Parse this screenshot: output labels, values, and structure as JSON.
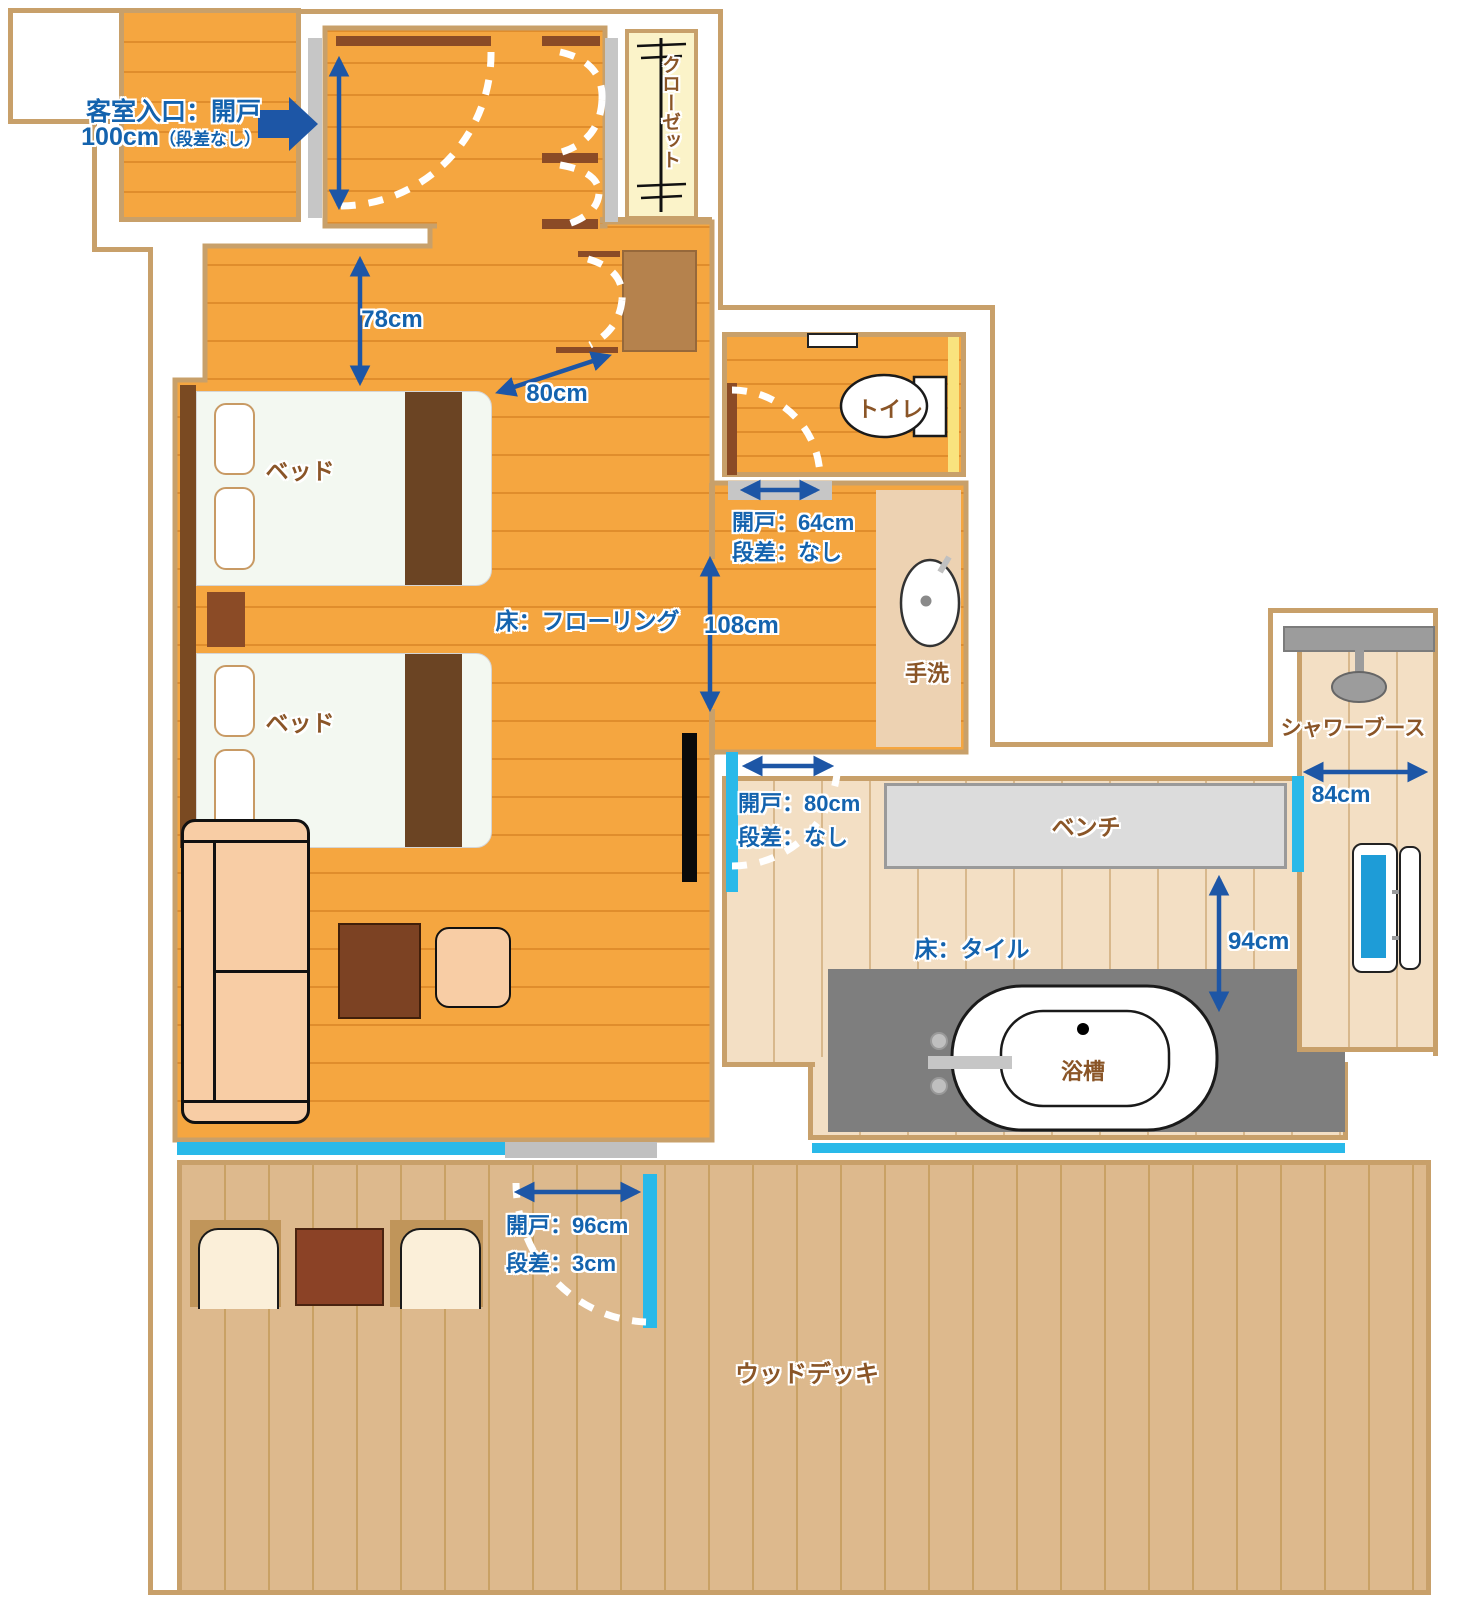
{
  "plan": {
    "entry": {
      "line1": "客室入口：開戸",
      "value": "100cm",
      "note": "（段差なし）"
    },
    "closet": {
      "label": "クローゼット"
    },
    "bedroom": {
      "bed1": "ベッド",
      "bed2": "ベッド",
      "floor": "床：フローリング"
    },
    "toilet": {
      "name": "トイレ",
      "door": "開戸：64cm",
      "step": "段差：なし"
    },
    "washbasin": {
      "label": "手洗"
    },
    "bathroom": {
      "floor": "床：タイル",
      "bench": "ベンチ",
      "tub": "浴槽",
      "shower": "シャワーブース",
      "door": "開戸：80cm",
      "step": "段差：なし"
    },
    "deck": {
      "name": "ウッドデッキ",
      "door": "開戸：96cm",
      "step": "段差：3cm"
    },
    "measurements": {
      "hall_width": "78cm",
      "closet_clearance": "80cm",
      "corridor_width": "108cm",
      "shower_width": "84cm",
      "bath_clearance": "94cm"
    },
    "colors": {
      "floor_orange": "#F5A640",
      "wall_tan": "#C8A06A",
      "tile_beige": "#F3DFC4",
      "deck_tan": "#DDB98D",
      "accent_cyan": "#29B9E9",
      "text_blue": "#1463AE",
      "text_brown": "#8A5527",
      "arrow_blue": "#1D56A6"
    }
  }
}
